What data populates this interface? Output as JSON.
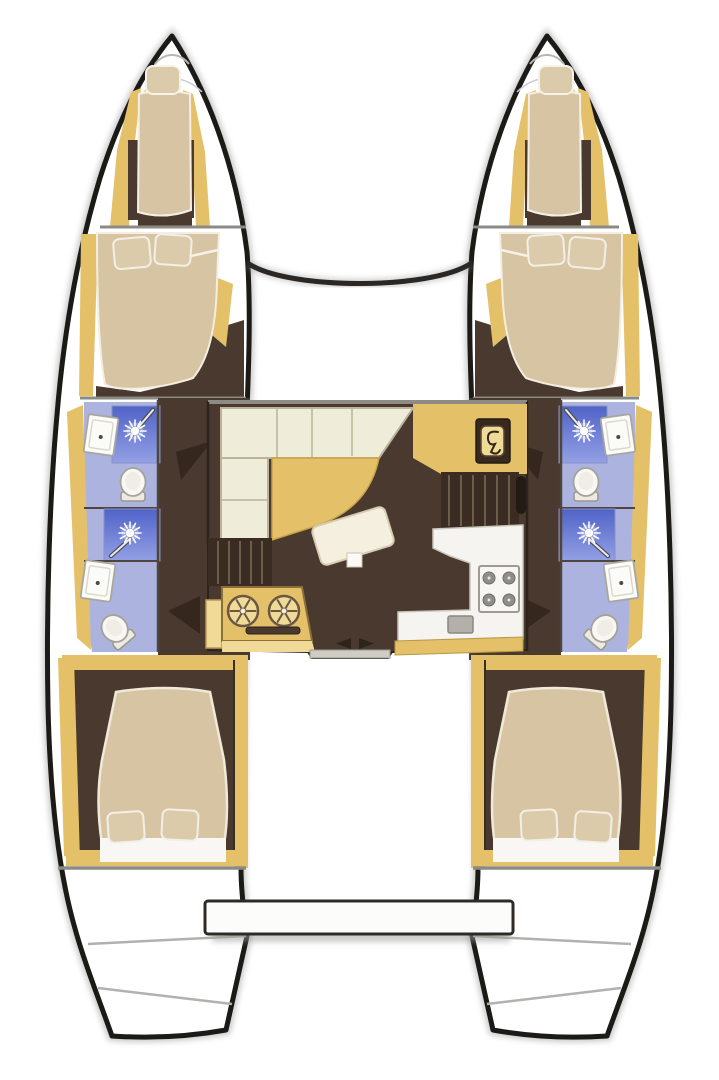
{
  "meta": {
    "title": "Catamaran interior layout plan (top-down view)",
    "view": "overhead floorplan",
    "text_labels_visible": "none"
  },
  "colors": {
    "deck_white": "#ffffff",
    "hull_outline": "#1c1a17",
    "hull_shadow": "#9f9f9f",
    "bulkhead_gray": "#8b8a84",
    "joinery_yellow": "#e4c169",
    "joinery_yellow_light": "#efdb97",
    "joinery_edge": "#b89a45",
    "floor_brown": "#4a392e",
    "floor_brown_dark": "#3a2c23",
    "mattress_tan": "#d7c4a3",
    "pillow_beige": "#dccbaa",
    "cushion_cream": "#f0ecda",
    "bath_floor_lavender": "#adb3df",
    "shower_blue": "#5063c8",
    "shower_blue_light": "#93a0e4",
    "fixture_white": "#f8f7f3",
    "counter_white": "#f5f4f0",
    "stove_gray": "#8f8e89",
    "door_swing_dark": "#35271d"
  },
  "vessel": {
    "type": "sailing catamaran",
    "layout_summary": "4 double cabins + 2 forepeak berths, 4 heads with showers, central saloon with galley, aft platform",
    "port_hull": {
      "side": "left",
      "rooms": [
        {
          "name": "forepeak berth",
          "furniture": [
            "single mattress",
            "pillow"
          ]
        },
        {
          "name": "forward cabin",
          "furniture": [
            "double bed",
            "2 pillows",
            "wardrobe"
          ]
        },
        {
          "name": "forward head",
          "fixtures": [
            "washbasin",
            "shower",
            "toilet"
          ]
        },
        {
          "name": "aft head",
          "fixtures": [
            "shower",
            "washbasin",
            "toilet"
          ]
        },
        {
          "name": "aft cabin",
          "furniture": [
            "double bed",
            "2 pillows"
          ]
        },
        {
          "name": "transom steps"
        }
      ]
    },
    "starboard_hull": {
      "side": "right",
      "note": "mirror image of port hull",
      "rooms": [
        {
          "name": "forepeak berth",
          "furniture": [
            "single mattress",
            "pillow"
          ]
        },
        {
          "name": "forward cabin",
          "furniture": [
            "double bed",
            "2 pillows",
            "wardrobe"
          ]
        },
        {
          "name": "forward head",
          "fixtures": [
            "washbasin",
            "shower",
            "toilet"
          ]
        },
        {
          "name": "aft head",
          "fixtures": [
            "shower",
            "washbasin",
            "toilet"
          ]
        },
        {
          "name": "aft cabin",
          "furniture": [
            "double bed",
            "2 pillows"
          ]
        },
        {
          "name": "transom steps"
        }
      ]
    },
    "bridgedeck": {
      "rooms": [
        {
          "name": "saloon",
          "furniture": [
            "L-shaped sofa",
            "curved dining table",
            "tilted coffee table",
            "chart table with helm panel"
          ]
        },
        {
          "name": "galley",
          "fixtures": [
            "4-burner stove",
            "sink",
            "L-shaped worktop"
          ]
        },
        {
          "name": "wet bar unit",
          "fixtures": [
            "twin round basins",
            "drawer slot"
          ]
        },
        {
          "name": "companionway steps to port hull"
        },
        {
          "name": "companionway steps to starboard hull"
        },
        {
          "name": "sliding door to cockpit",
          "detail": "two opposing arrows"
        }
      ]
    },
    "exterior": [
      "forward crossbeam between bows",
      "foredeck",
      "cockpit",
      "aft bench platform",
      "twin transom scoops"
    ]
  },
  "icon_legend": {
    "sun_burst": "shower head",
    "diagonal_rod": "hand shower wand",
    "oval_with_tank": "toilet (top view)",
    "rect_with_dot": "washbasin",
    "four_circles": "stove burners",
    "spoked_circles": "twin basins",
    "wheel_glyph": "helm / instrument panel",
    "opposing_triangles": "sliding door direction"
  }
}
